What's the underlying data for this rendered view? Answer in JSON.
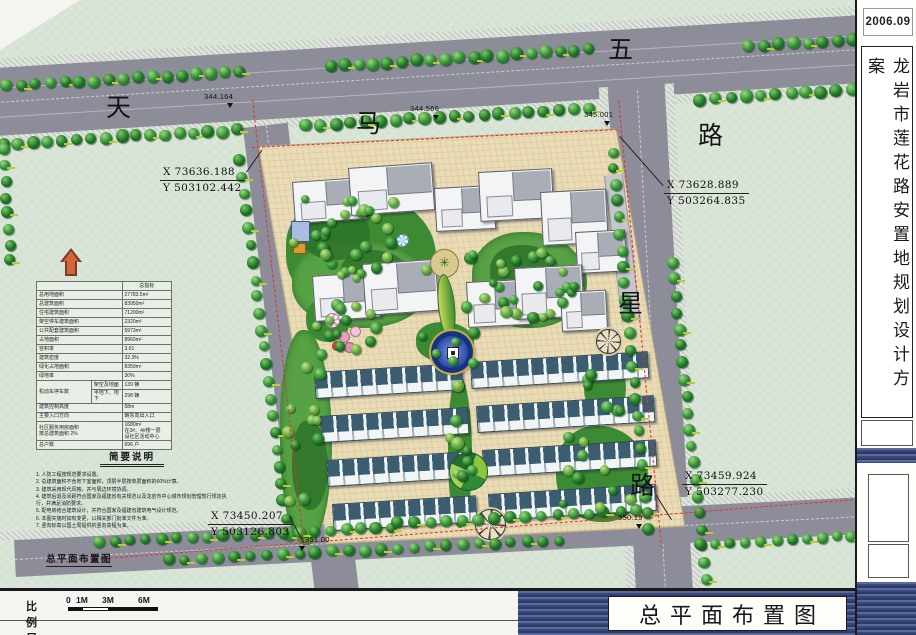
{
  "titleblock": {
    "date": "2006.09",
    "project_title": "龙岩市莲花路安置地规划设计方案",
    "drawing_title": "总平面布置图"
  },
  "plan": {
    "drawing_label": "总平面布置图",
    "roads": {
      "tianma_chars": [
        "天",
        "马",
        "路"
      ],
      "wuxing_chars": [
        "五",
        "星",
        "路"
      ],
      "elevations": [
        "344.164",
        "344.566",
        "345.001",
        "351.00",
        "350.19"
      ]
    },
    "coordinates": [
      {
        "x": "X 73636.188",
        "y": "Y 503102.442"
      },
      {
        "x": "X 73628.889",
        "y": "Y 503264.835"
      },
      {
        "x": "X 73459.924",
        "y": "Y 503277.230"
      },
      {
        "x": "X 73450.207",
        "y": "Y 503126.803"
      }
    ]
  },
  "indicators": {
    "header": "总指标",
    "rows": [
      {
        "label": "总用地面积",
        "value": "27783.5m²"
      },
      {
        "label": "总建筑面积",
        "value": "83950m²"
      },
      {
        "label": "住宅建筑面积",
        "value": "71200m²"
      },
      {
        "label": "架空停车建筑面积",
        "value": "2320m²"
      },
      {
        "label": "公共配套建筑面积",
        "value": "5973m²"
      },
      {
        "label": "占地面积",
        "value": "8960m²"
      },
      {
        "label": "容积率",
        "value": "3.01"
      },
      {
        "label": "建筑密度",
        "value": "32.3%"
      },
      {
        "label": "绿化占地面积",
        "value": "8350m²"
      },
      {
        "label": "绿地率",
        "value": "30%"
      },
      {
        "label": "机动车停车数",
        "sub": [
          {
            "label": "架空及地面",
            "value": "139 辆"
          },
          {
            "label": "半地下、地下",
            "value": "298 辆"
          }
        ]
      },
      {
        "label": "建筑控制高度",
        "value": "58m"
      },
      {
        "label": "主要入口方向",
        "value": "朝东向出入口"
      },
      {
        "label": "社区服务用房面积\n按总建筑面积 2%",
        "value": "1680m²\n在3#、4#楼一层\n设社区活动中心"
      },
      {
        "label": "总户数",
        "value": "696 户"
      }
    ]
  },
  "notes": {
    "title": "简要说明",
    "items": [
      "1. 人防工程按规范要求设置。",
      "2. 总建筑面积不含地下室面积，顶层半层按单层面积的60%计算。",
      "3. 建筑采用现代风格，并与周边环境协调。",
      "4. 建筑后退及间距符合国家及福建省有关规范以及龙岩市中心城市规划管理暂行规定执行，并满足消防要求。",
      "5. 配电房结合建筑设计，并符合国家及福建省建筑电气设计规范。",
      "6. 本图实施时如有变更，以相关部门批准文件为准。",
      "7. 竖向标高以国土局提供的竖向高程为准。"
    ]
  },
  "scalebar": {
    "label": "比例尺",
    "ticks": [
      "0",
      "1M",
      "3M",
      "6M"
    ]
  },
  "colors": {
    "sheet_green": "#d6e3d4",
    "road_gray": "#8d8d99",
    "site_cream": "#e9dcb6",
    "boundary_red": "#e03030",
    "townhouse_roof": "#3c5d70",
    "band_navy": "#3a4878",
    "fountain_blue": "#15337e",
    "tree_green": "#2e8b32"
  }
}
